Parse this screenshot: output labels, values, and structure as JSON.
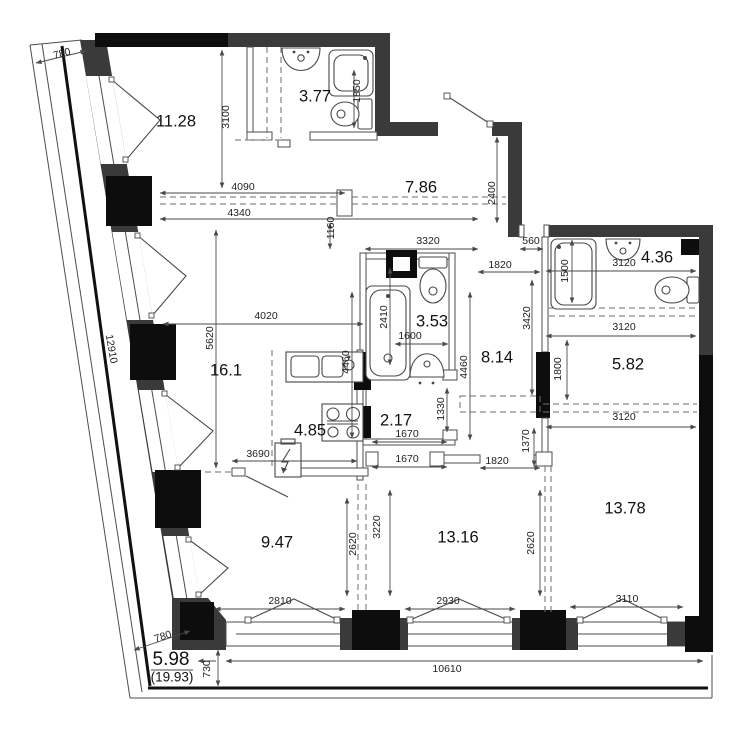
{
  "plan": {
    "colors": {
      "wall": "#3a3a3a",
      "column": "#0d0d0d",
      "line": "#4a4a4a",
      "background": "#ffffff"
    },
    "rooms": [
      {
        "label": "11.28",
        "x": 176,
        "y": 122
      },
      {
        "label": "3.77",
        "x": 315,
        "y": 97
      },
      {
        "label": "7.86",
        "x": 421,
        "y": 188
      },
      {
        "label": "4.36",
        "x": 657,
        "y": 258
      },
      {
        "label": "3.53",
        "x": 432,
        "y": 322
      },
      {
        "label": "8.14",
        "x": 497,
        "y": 358
      },
      {
        "label": "5.82",
        "x": 628,
        "y": 365
      },
      {
        "label": "16.1",
        "x": 226,
        "y": 371
      },
      {
        "label": "4.85",
        "x": 310,
        "y": 431
      },
      {
        "label": "2.17",
        "x": 396,
        "y": 421
      },
      {
        "label": "9.47",
        "x": 277,
        "y": 543
      },
      {
        "label": "13.16",
        "x": 458,
        "y": 538
      },
      {
        "label": "13.78",
        "x": 625,
        "y": 509
      }
    ],
    "dimensions": [
      {
        "text": "780",
        "x": 62,
        "y": 54,
        "rot": -15
      },
      {
        "text": "3100",
        "x": 226,
        "y": 117,
        "rot": -90
      },
      {
        "text": "4090",
        "x": 243,
        "y": 187
      },
      {
        "text": "4340",
        "x": 239,
        "y": 213
      },
      {
        "text": "1850",
        "x": 357,
        "y": 91,
        "rot": -90
      },
      {
        "text": "1160",
        "x": 331,
        "y": 228,
        "rot": -90
      },
      {
        "text": "2400",
        "x": 492,
        "y": 193,
        "rot": -90
      },
      {
        "text": "3320",
        "x": 428,
        "y": 241
      },
      {
        "text": "560",
        "x": 531,
        "y": 241
      },
      {
        "text": "1820",
        "x": 500,
        "y": 265
      },
      {
        "text": "3120",
        "x": 624,
        "y": 263
      },
      {
        "text": "1500",
        "x": 565,
        "y": 271,
        "rot": -90
      },
      {
        "text": "2410",
        "x": 384,
        "y": 317,
        "rot": -90
      },
      {
        "text": "3420",
        "x": 527,
        "y": 318,
        "rot": -90
      },
      {
        "text": "4020",
        "x": 266,
        "y": 316
      },
      {
        "text": "5620",
        "x": 210,
        "y": 338,
        "rot": -90
      },
      {
        "text": "1600",
        "x": 410,
        "y": 336
      },
      {
        "text": "4460",
        "x": 346,
        "y": 362,
        "rot": -90
      },
      {
        "text": "4460",
        "x": 464,
        "y": 367,
        "rot": -90
      },
      {
        "text": "3120",
        "x": 624,
        "y": 327
      },
      {
        "text": "1800",
        "x": 558,
        "y": 369,
        "rot": -90
      },
      {
        "text": "3120",
        "x": 624,
        "y": 417
      },
      {
        "text": "1330",
        "x": 441,
        "y": 409,
        "rot": -90
      },
      {
        "text": "1670",
        "x": 407,
        "y": 434
      },
      {
        "text": "1670",
        "x": 407,
        "y": 459
      },
      {
        "text": "3690",
        "x": 258,
        "y": 454
      },
      {
        "text": "1820",
        "x": 497,
        "y": 461
      },
      {
        "text": "1370",
        "x": 526,
        "y": 441,
        "rot": -90
      },
      {
        "text": "2620",
        "x": 353,
        "y": 544,
        "rot": -90
      },
      {
        "text": "3220",
        "x": 377,
        "y": 527,
        "rot": -90
      },
      {
        "text": "2620",
        "x": 531,
        "y": 543,
        "rot": -90
      },
      {
        "text": "2810",
        "x": 280,
        "y": 601
      },
      {
        "text": "2930",
        "x": 448,
        "y": 601
      },
      {
        "text": "3110",
        "x": 627,
        "y": 599
      },
      {
        "text": "10610",
        "x": 447,
        "y": 669
      },
      {
        "text": "730",
        "x": 207,
        "y": 669,
        "rot": -90
      },
      {
        "text": "780",
        "x": 163,
        "y": 637,
        "rot": -18
      },
      {
        "text": "12910",
        "x": 111,
        "y": 349,
        "rot": 80
      }
    ],
    "area_summary": {
      "main": "5.98",
      "total": "(19.93)"
    }
  }
}
